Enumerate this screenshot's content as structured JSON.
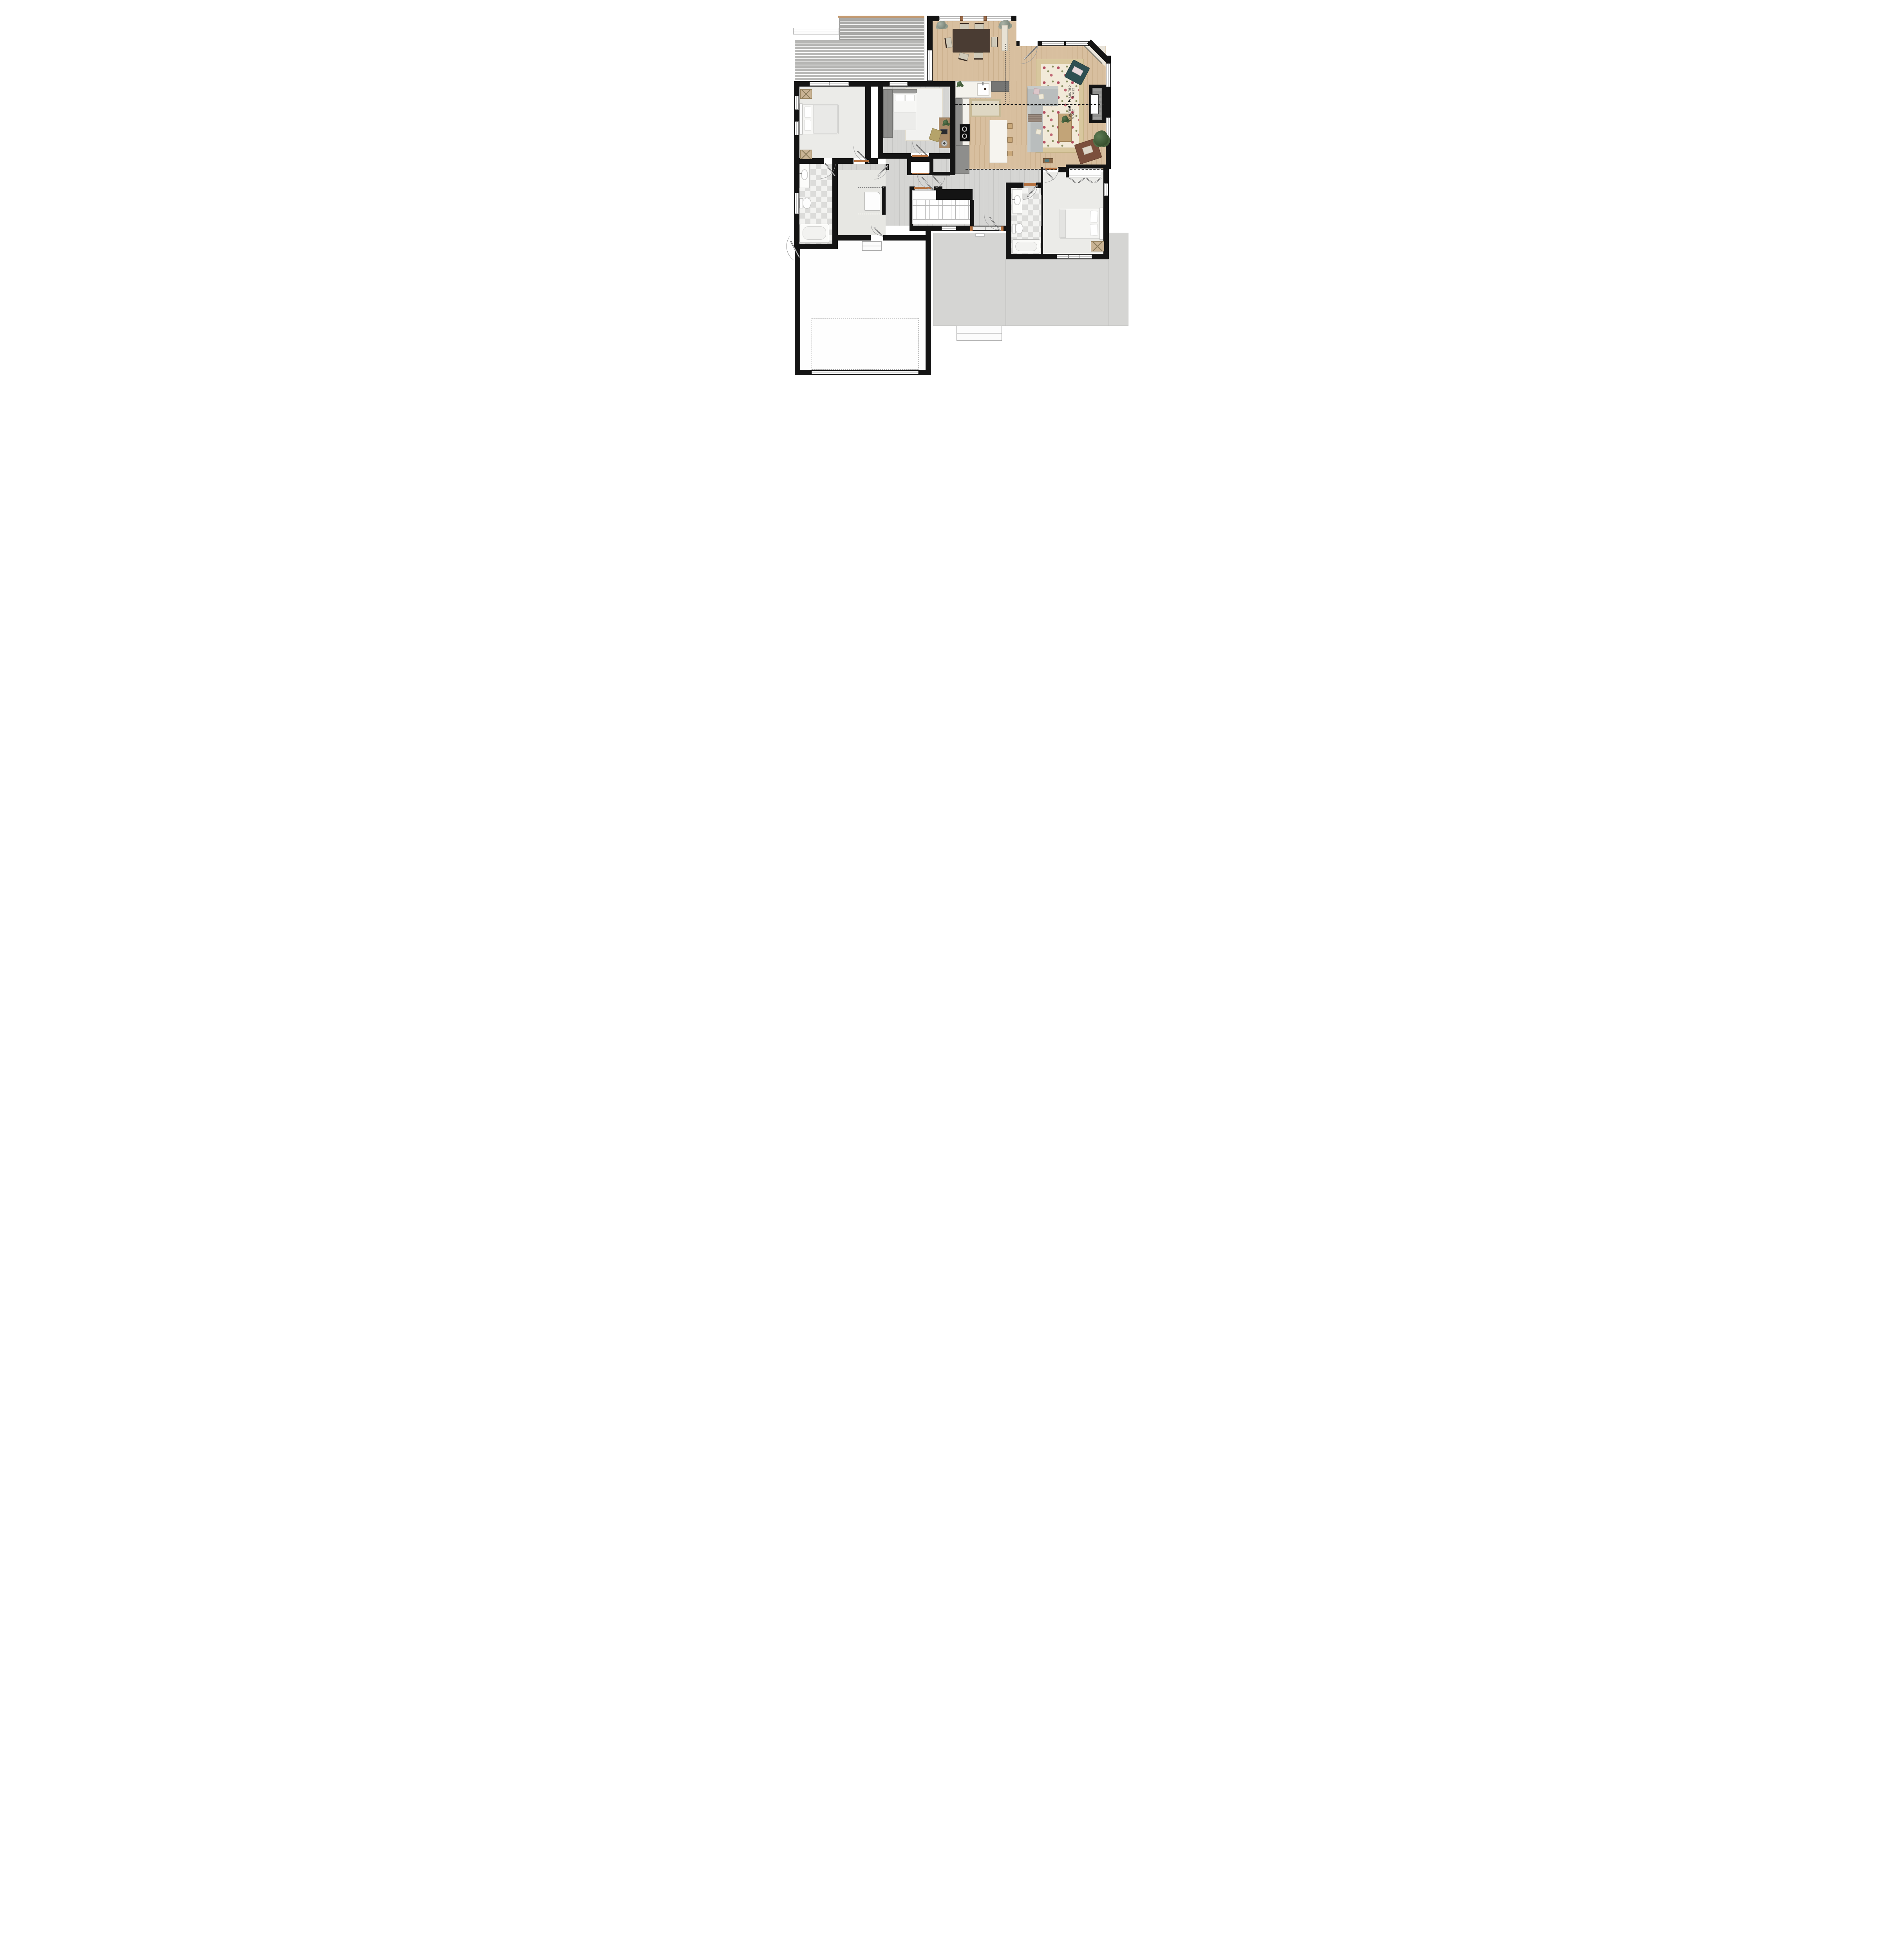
{
  "annotations": {
    "vault_upper": {
      "label": "VAULTED",
      "pitch": "3.5/12"
    },
    "vault_lower": {
      "label": "VAULTED",
      "pitch": "3.5/12"
    }
  },
  "palette": {
    "wall": "#141414",
    "wood_main": "#d8bf9f",
    "wood_hall": "#d5d5d3",
    "carpet": "#ebebe8",
    "tile_light": "#f3f3f1",
    "tile_dark": "#dcdcda",
    "deck": "#b6b6b4",
    "concrete": "#d5d5d3",
    "rug_base": "#f2ead9",
    "rug_accent": "#b44f60",
    "jute_border": "#d8c79e",
    "sofa_gray": "#b9bdbd",
    "armchair_teal": "#2e4f52",
    "armchair_brown": "#7b4f3c",
    "island_marble": "#f6f4ef",
    "cabinet_gray": "#8e8e8c",
    "dining_table": "#4a3c33",
    "door_leaf": "#fdfdfd",
    "threshold_wood": "#b5713f"
  }
}
